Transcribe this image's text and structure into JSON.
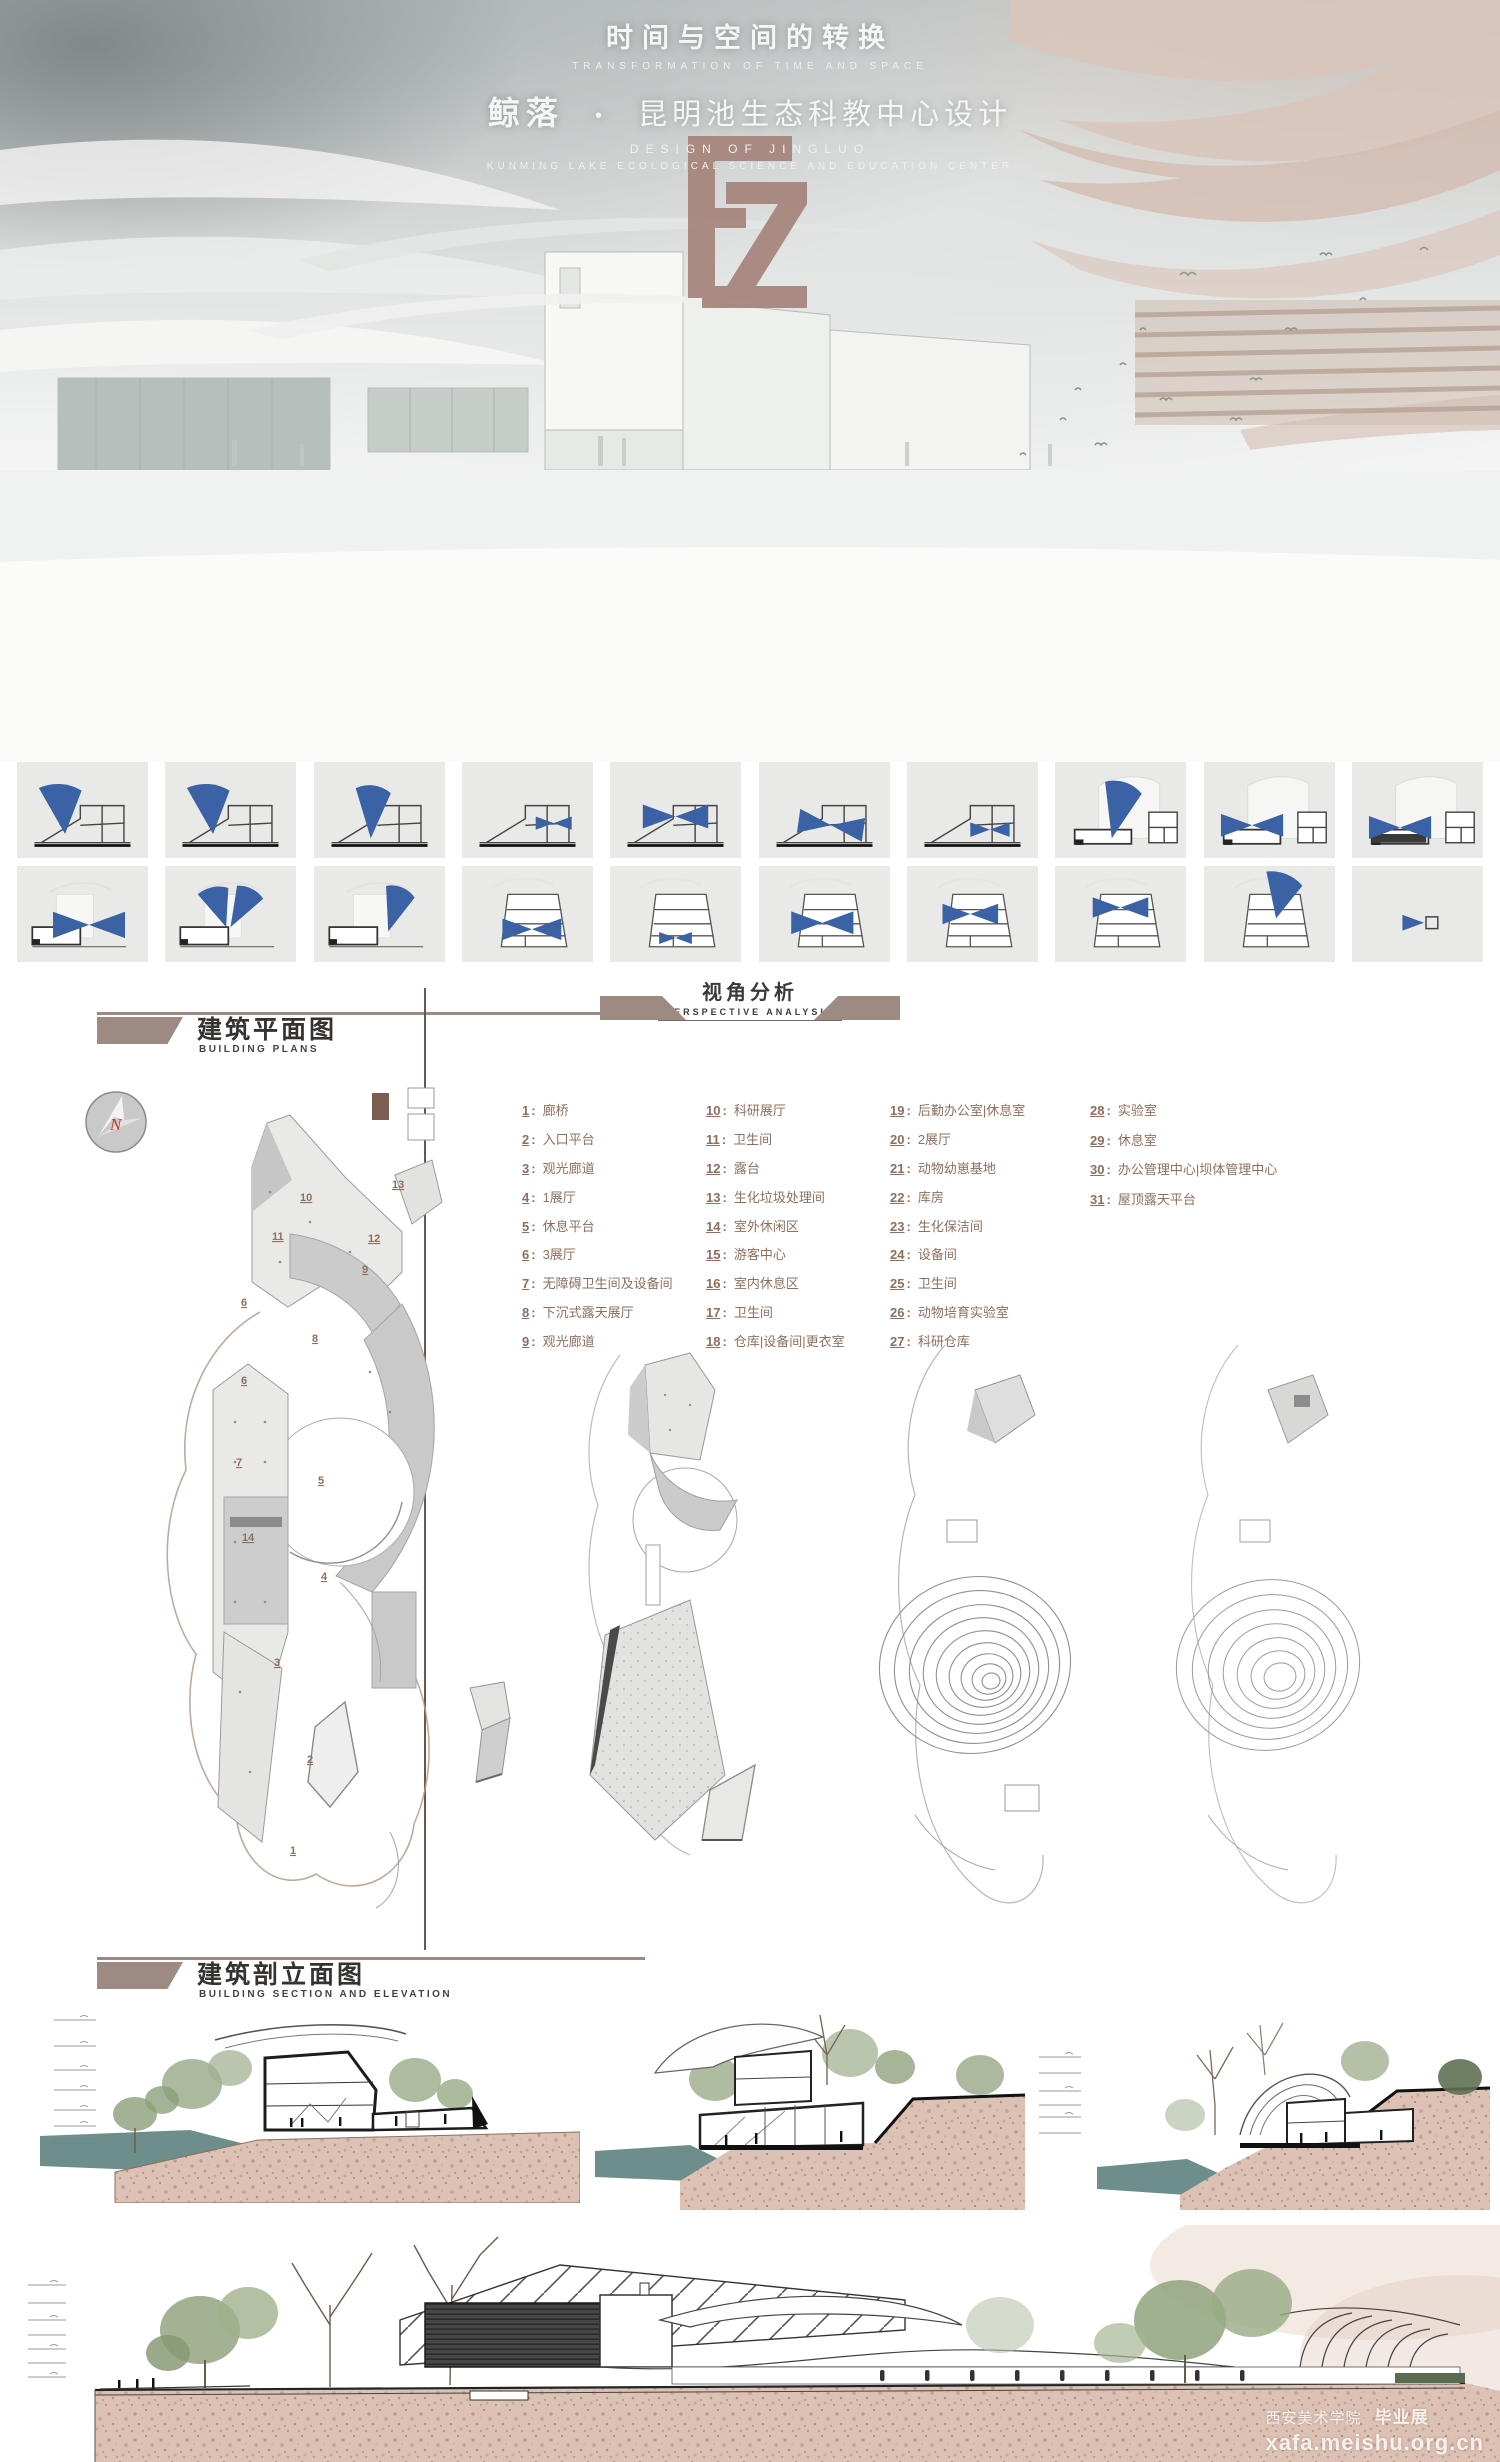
{
  "header": {
    "title_zh": "时间与空间的转换",
    "title_en": "TRANSFORMATION OF TIME AND SPACE",
    "project_name_zh": "鲸落",
    "separator": "•",
    "project_desc_zh": "昆明池生态科教中心设计",
    "subtitle_en1": "DESIGN OF JINGLUO",
    "subtitle_en2": "KUNMING LAKE ECOLOGICAL SCIENCE AND EDUCATION CENTER",
    "logo_monogram": "FZ"
  },
  "perspective": {
    "title_zh": "视角分析",
    "title_en": "PERSPECTIVE ANALYSIS",
    "thumbnails_row1": [
      {
        "glyph": "view-fan-icon"
      },
      {
        "glyph": "view-fan-icon"
      },
      {
        "glyph": "view-cone-icon"
      },
      {
        "glyph": "view-bowtie-icon"
      },
      {
        "glyph": "view-bowtie-icon"
      },
      {
        "glyph": "view-bowtie-icon"
      },
      {
        "glyph": "view-bowtie-icon"
      },
      {
        "glyph": "view-cone-icon"
      },
      {
        "glyph": "view-bowtie-icon"
      },
      {
        "glyph": "view-bowtie-icon"
      }
    ],
    "thumbnails_row2": [
      {
        "glyph": "view-bowtie-icon"
      },
      {
        "glyph": "view-fan-pair-icon"
      },
      {
        "glyph": "view-cone-icon"
      },
      {
        "glyph": "view-bowtie-icon"
      },
      {
        "glyph": "view-bowtie-icon"
      },
      {
        "glyph": "view-bowtie-icon"
      },
      {
        "glyph": "view-bowtie-icon"
      },
      {
        "glyph": "view-bowtie-icon"
      },
      {
        "glyph": "view-fan-icon"
      },
      {
        "glyph": "view-arrow-icon"
      }
    ]
  },
  "plans": {
    "title_zh": "建筑平面图",
    "title_en": "BUILDING PLANS",
    "compass_letter": "N",
    "legend": [
      {
        "num": "1",
        "label": "廊桥"
      },
      {
        "num": "2",
        "label": "入口平台"
      },
      {
        "num": "3",
        "label": "观光廊道"
      },
      {
        "num": "4",
        "label": "1展厅"
      },
      {
        "num": "5",
        "label": "休息平台"
      },
      {
        "num": "6",
        "label": "3展厅"
      },
      {
        "num": "7",
        "label": "无障碍卫生间及设备间"
      },
      {
        "num": "8",
        "label": "下沉式露天展厅"
      },
      {
        "num": "9",
        "label": "观光廊道"
      },
      {
        "num": "10",
        "label": "科研展厅"
      },
      {
        "num": "11",
        "label": "卫生间"
      },
      {
        "num": "12",
        "label": "露台"
      },
      {
        "num": "13",
        "label": "生化垃圾处理间"
      },
      {
        "num": "14",
        "label": "室外休闲区"
      },
      {
        "num": "15",
        "label": "游客中心"
      },
      {
        "num": "16",
        "label": "室内休息区"
      },
      {
        "num": "17",
        "label": "卫生间"
      },
      {
        "num": "18",
        "label": "仓库|设备间|更衣室"
      },
      {
        "num": "19",
        "label": "后勤办公室|休息室"
      },
      {
        "num": "20",
        "label": "2展厅"
      },
      {
        "num": "21",
        "label": "动物幼崽基地"
      },
      {
        "num": "22",
        "label": "库房"
      },
      {
        "num": "23",
        "label": "生化保洁间"
      },
      {
        "num": "24",
        "label": "设备间"
      },
      {
        "num": "25",
        "label": "卫生间"
      },
      {
        "num": "26",
        "label": "动物培育实验室"
      },
      {
        "num": "27",
        "label": "科研仓库"
      },
      {
        "num": "28",
        "label": "实验室"
      },
      {
        "num": "29",
        "label": "休息室"
      },
      {
        "num": "30",
        "label": "办公管理中心|坝体管理中心"
      },
      {
        "num": "31",
        "label": "屋顶露天平台"
      }
    ],
    "plan1_numbers": [
      "13",
      "10",
      "11",
      "12",
      "9",
      "8",
      "6",
      "6",
      "7",
      "5",
      "14",
      "4",
      "3",
      "2",
      "1"
    ]
  },
  "sections": {
    "title_zh": "建筑剖立面图",
    "title_en": "BUILDING SECTION AND ELEVATION"
  },
  "watermark": {
    "school": "西安美术学院",
    "exhibition": "毕业展",
    "site": "xafa.meishu.org.cn"
  }
}
